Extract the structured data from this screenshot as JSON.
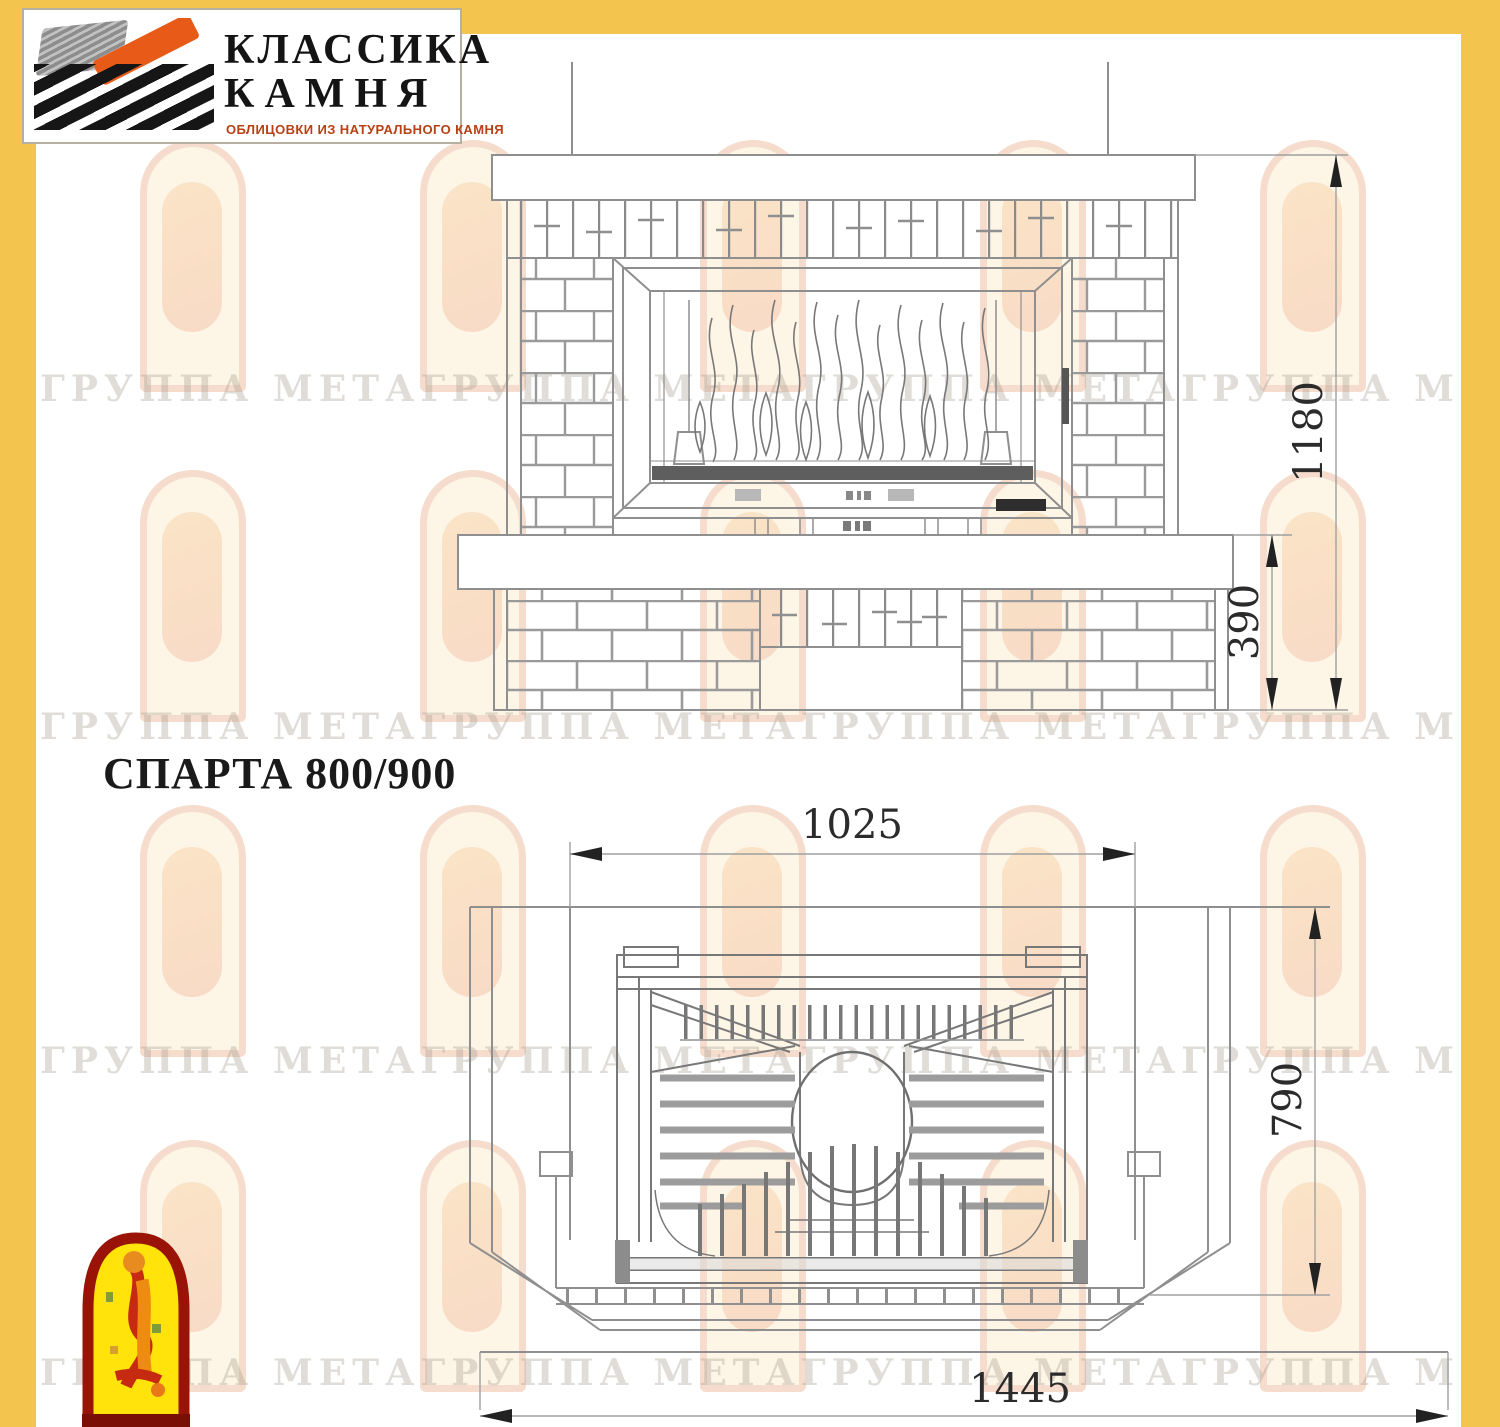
{
  "brand": {
    "name_line1": "КЛАССИКА",
    "name_line2": "КАМНЯ",
    "tagline": "ОБЛИЦОВКИ ИЗ НАТУРАЛЬНОГО КАМНЯ"
  },
  "title": "СПАРТА 800/900",
  "front_view": {
    "total_height": "1180",
    "base_height": "390"
  },
  "plan_view": {
    "insert_width": "1025",
    "depth": "790",
    "front_width": "1445"
  },
  "watermark": {
    "line": "ГРУППА МЕТАГРУППА МЕТАГРУППА МЕТАГРУППА МЕТАГРУППА МЕТАГРУППА МЕТА"
  },
  "colors": {
    "frame_yellow": "#F3C44E",
    "logo_orange": "#E85A17",
    "tagline_red": "#B74015",
    "drawing_line": "#8f8f8f",
    "dark_strip": "#5e5e5e",
    "meta_red": "#991407",
    "meta_yellow": "#FFE30A",
    "meta_orange": "#EE8C12"
  }
}
